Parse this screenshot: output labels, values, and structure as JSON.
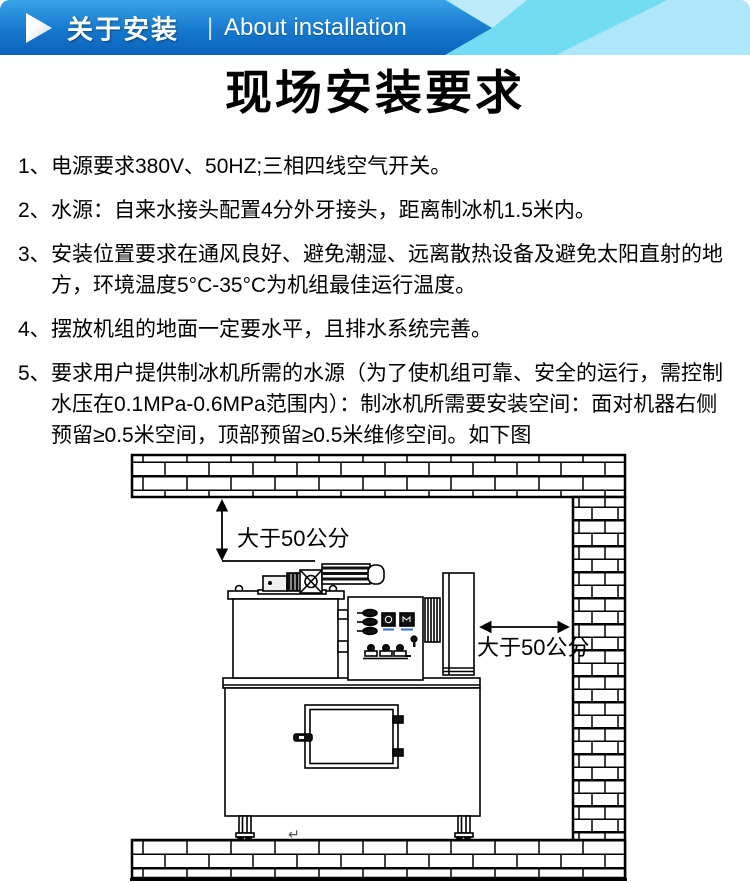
{
  "header": {
    "title_zh": "关于安装",
    "divider": "|",
    "title_en": "About installation",
    "play_icon": "right-triangle"
  },
  "page": {
    "title": "现场安装要求"
  },
  "requirements": [
    {
      "num": "1、",
      "text": "电源要求380V、50HZ;三相四线空气开关。"
    },
    {
      "num": "2、",
      "text": "水源：自来水接头配置4分外牙接头，距离制冰机1.5米内。"
    },
    {
      "num": "3、",
      "text": "安装位置要求在通风良好、避免潮湿、远离散热设备及避免太阳直射的地方，环境温度5°C-35°C为机组最佳运行温度。"
    },
    {
      "num": "4、",
      "text": "摆放机组的地面一定要水平，且排水系统完善。"
    },
    {
      "num": "5、",
      "text": "要求用户提供制冰机所需的水源（为了使机组可靠、安全的运行，需控制水压在0.1MPa-0.6MPa范围内）：制冰机所需要安装空间：面对机器右侧预留≥0.5米空间，顶部预留≥0.5米维修空间。如下图"
    }
  ],
  "diagram": {
    "top_clearance_label": "大于50公分",
    "right_clearance_label": "大于50公分",
    "drain_symbol": "↵"
  },
  "colors": {
    "banner_blue_top": "#39a3e9",
    "banner_blue_bottom": "#0c63bc",
    "banner_cyan": "#72dcf3",
    "banner_cyan_light": "#aee7f9",
    "line_art": "#000000",
    "meter_tick_blue": "#2f6fd6"
  }
}
